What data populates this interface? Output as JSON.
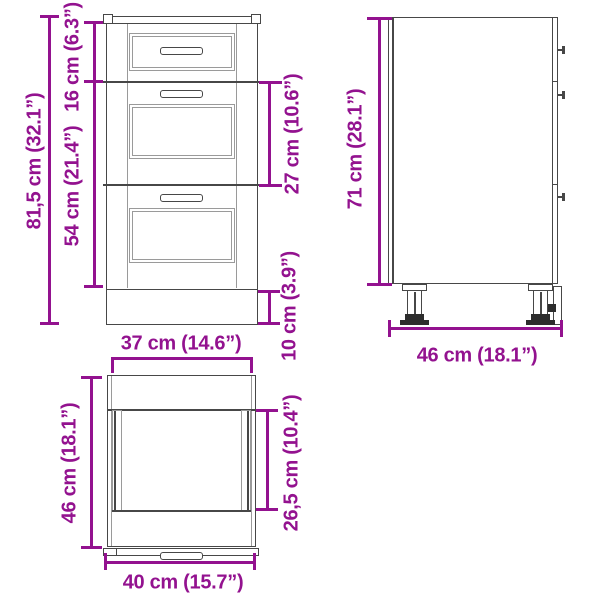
{
  "diagram_title": "cabinet-dimension-diagram",
  "colors": {
    "dimension_accent": "#93128f",
    "outline": "#474747",
    "panel_line": "#9a9a9a",
    "foot": "#2d2d2d",
    "background": "#ffffff"
  },
  "dimensions": {
    "front_total_height": "81,5 cm (32.1”)",
    "front_top_drawer_height": "16 cm (6.3”)",
    "front_lower_drawers_height": "54 cm (21.4”)",
    "front_middle_drawers_height": "27 cm (10.6”)",
    "front_plinth_height": "10 cm (3.9”)",
    "side_height": "71 cm (28.1”)",
    "side_depth": "46 cm (18.1”)",
    "top_body_width": "37 cm (14.6”)",
    "top_depth": "46 cm (18.1”)",
    "top_inner_depth": "26,5 cm (10.4”)",
    "top_overall_width": "40 cm (15.7”)"
  }
}
